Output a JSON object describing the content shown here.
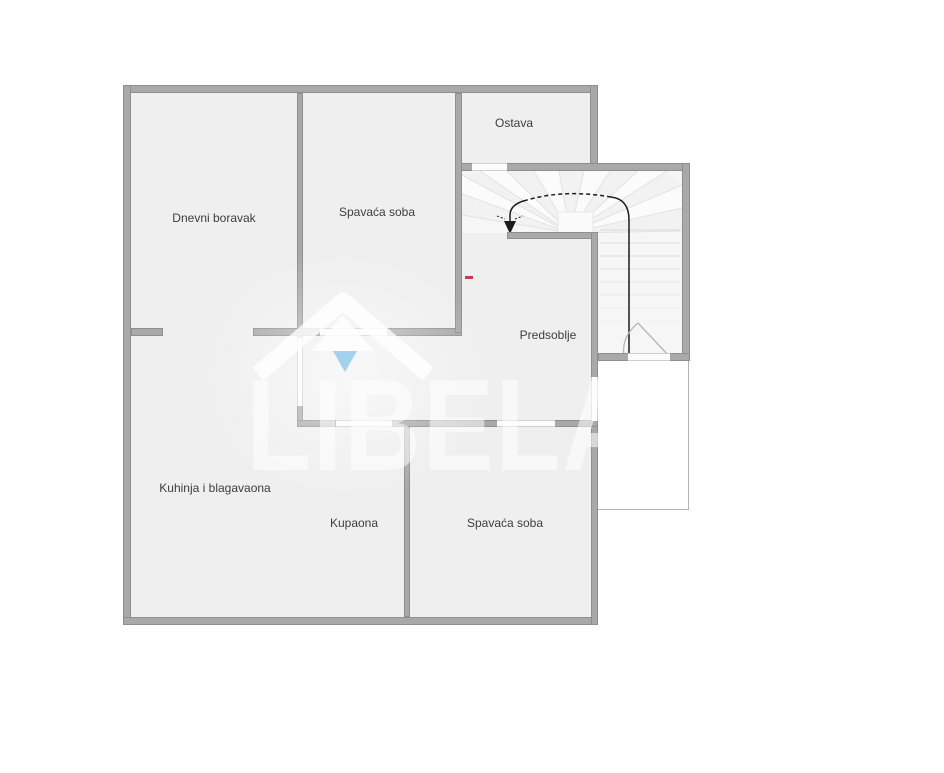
{
  "floorplan": {
    "rooms": {
      "dnevni_boravak": "Dnevni boravak",
      "spavaca_soba_top": "Spavaća soba",
      "ostava": "Ostava",
      "predsoblje": "Predsoblje",
      "kuhinja": "Kuhinja i blagavaona",
      "kupaona": "Kupaona",
      "spavaca_soba_bottom": "Spavaća soba"
    },
    "watermark": {
      "brand": "LIBELA",
      "logo": "house-with-up-arrow",
      "logo_accent_blue": "#a2d1eb"
    },
    "colors": {
      "background": "#ffffff",
      "floor": "#efefef",
      "wall": "#a9a9a9",
      "stair_area": "#f6f6f6",
      "red_marker": "#bf4150",
      "label_text": "#3d3d3d"
    }
  }
}
